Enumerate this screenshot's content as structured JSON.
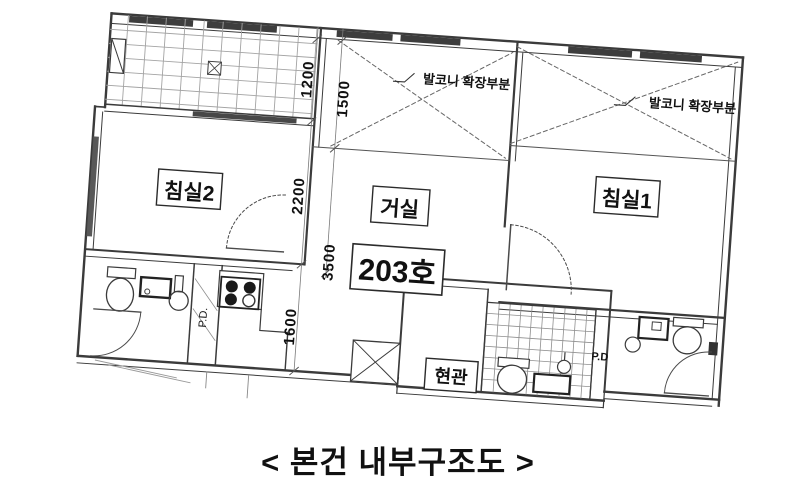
{
  "caption": "< 본건 내부구조도 >",
  "plan": {
    "unit_number": "203호",
    "rooms": [
      {
        "id": "bedroom2",
        "label": "침실2"
      },
      {
        "id": "living_room",
        "label": "거실"
      },
      {
        "id": "bedroom1",
        "label": "침실1"
      },
      {
        "id": "entrance",
        "label": "현관"
      }
    ],
    "annotations": [
      {
        "id": "balcony_extension_left",
        "label": "발코니 확장부분"
      },
      {
        "id": "balcony_extension_right",
        "label": "발코니 확장부분"
      },
      {
        "id": "pipe_duct_left",
        "label": "P.D."
      },
      {
        "id": "pipe_duct_right",
        "label": "P.D"
      }
    ],
    "dimensions_mm": [
      {
        "id": "dim_1200",
        "value": "1200"
      },
      {
        "id": "dim_1500",
        "value": "1500"
      },
      {
        "id": "dim_2200",
        "value": "2200"
      },
      {
        "id": "dim_3500",
        "value": "3500"
      },
      {
        "id": "dim_1600",
        "value": "1600"
      }
    ]
  },
  "colors": {
    "background": "#ffffff",
    "wall": "#3b3b3b",
    "grid_line": "#a3a3a3",
    "window_fill": "#3d3d3d",
    "dim_line": "#7a7a7a",
    "text": "#111111"
  }
}
